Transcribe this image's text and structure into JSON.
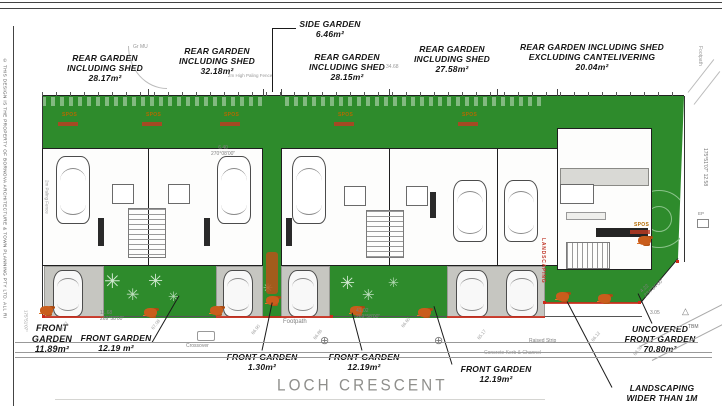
{
  "sheet": {
    "copyright": "© THIS DESIGN IS THE PROPERTY OF BORNOVA ARCHITECTURE & TOWN PLANNING PTY LTD. ALL RI"
  },
  "annotations": {
    "rear": [
      {
        "l1": "REAR GARDEN",
        "l2": "INCLUDING SHED",
        "area": "28.17m²"
      },
      {
        "l1": "REAR GARDEN",
        "l2": "INCLUDING SHED",
        "area": "32.18m²"
      },
      {
        "l1": "SIDE GARDEN",
        "l2": "",
        "area": "6.46m²"
      },
      {
        "l1": "REAR GARDEN",
        "l2": "INCLUDING SHED",
        "area": "28.15m²"
      },
      {
        "l1": "REAR GARDEN",
        "l2": "INCLUDING SHED",
        "area": "27.58m²"
      },
      {
        "l1": "REAR GARDEN INCLUDING SHED",
        "l2": "EXCLUDING CANTELIVERING",
        "area": "20.04m²"
      }
    ],
    "front": [
      {
        "l1": "FRONT",
        "l2": "GARDEN",
        "area": "11.89m²"
      },
      {
        "l1": "FRONT GARDEN",
        "l2": "",
        "area": "12.19 m²"
      },
      {
        "l1": "FRONT GARDEN",
        "l2": "",
        "area": "1.30m²"
      },
      {
        "l1": "FRONT GARDEN",
        "l2": "",
        "area": "12.19m²"
      },
      {
        "l1": "FRONT GARDEN",
        "l2": "",
        "area": "12.19m²"
      },
      {
        "l1": "UNCOVERED",
        "l2": "FRONT GARDEN",
        "area": "70.80m²"
      },
      {
        "l1": "LANDSCAPING",
        "l2": "WIDER THAN 1M",
        "area": ""
      }
    ],
    "landscaping_side": "LANDSCAPING",
    "spos_label": "SPOS"
  },
  "street": {
    "name": "LOCH CRESCENT",
    "footpath": "Footpath",
    "footpath_right": "Footpath",
    "crossover": "Crossover",
    "raised_strip": "Raised Strip",
    "kerb": "Concrete Kerb & Channel"
  },
  "dimensions": {
    "d640": "6.40",
    "b270": "270°08'00\"",
    "d3468": "34.68",
    "d1168": "11.68",
    "b269a": "269°58'00\"",
    "d4102": "41.02",
    "b269b": "269°58'00\"",
    "right_bearing": "175°51'07\" 12.58",
    "left_bearing": "175°51'07\"",
    "d422": "4.22",
    "b234": "234°34'00\"",
    "d305": "3.05",
    "tbm": "TBM",
    "ep": "EP",
    "grmu": "Gr MU",
    "fence_top": "2m High Paling Fence",
    "fence_left": "2m Paling Fence"
  },
  "spot_levels": [
    "67.22",
    "67.08",
    "66.90",
    "66.86",
    "66.60",
    "65.17",
    "66.12",
    "68.36"
  ]
}
